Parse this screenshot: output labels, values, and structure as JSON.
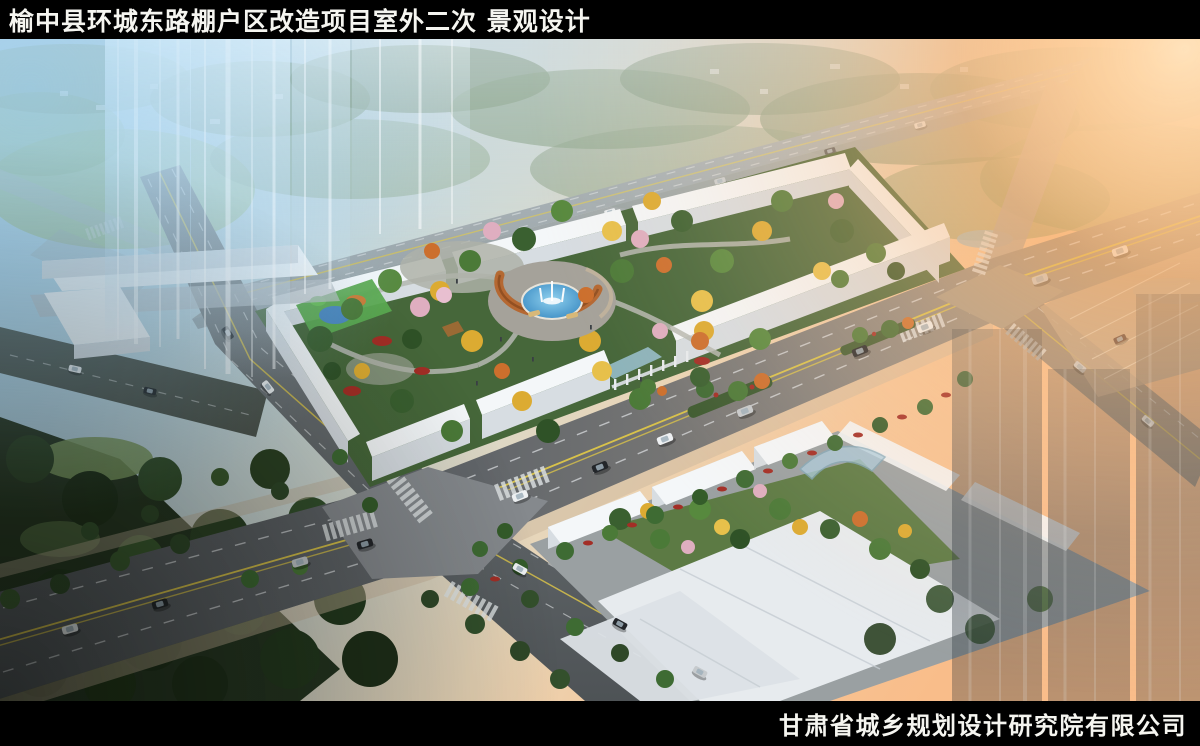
{
  "header": {
    "title": "榆中县环城东路棚户区改造项目室外二次 景观设计"
  },
  "footer": {
    "company": "甘肃省城乡规划设计研究院有限公司"
  },
  "colors": {
    "frame_black": "#000000",
    "title_text": "#f5f5f0",
    "sky_blue": "#a2cde7",
    "sunset_orange": "#ffb064",
    "road_gray": "#5f6468",
    "plaza_gray": "#85898d",
    "lane_yellow": "#d8c24a",
    "marking_white": "#dfe3e5",
    "building_white": "#f4f7f9",
    "building_face": "#d7dde2",
    "park_green": "#46673a",
    "tree_green": "#3e6b33",
    "tree_gold": "#dcab32",
    "tree_orange": "#cc6f2d",
    "blossom_pink": "#dfaec0",
    "shrub_red": "#a32e26",
    "water_blue": "#4a9cd2",
    "pergola_rust": "#b5652c",
    "dark_park": "#263621",
    "ghost_glass": "#cde4f4"
  }
}
